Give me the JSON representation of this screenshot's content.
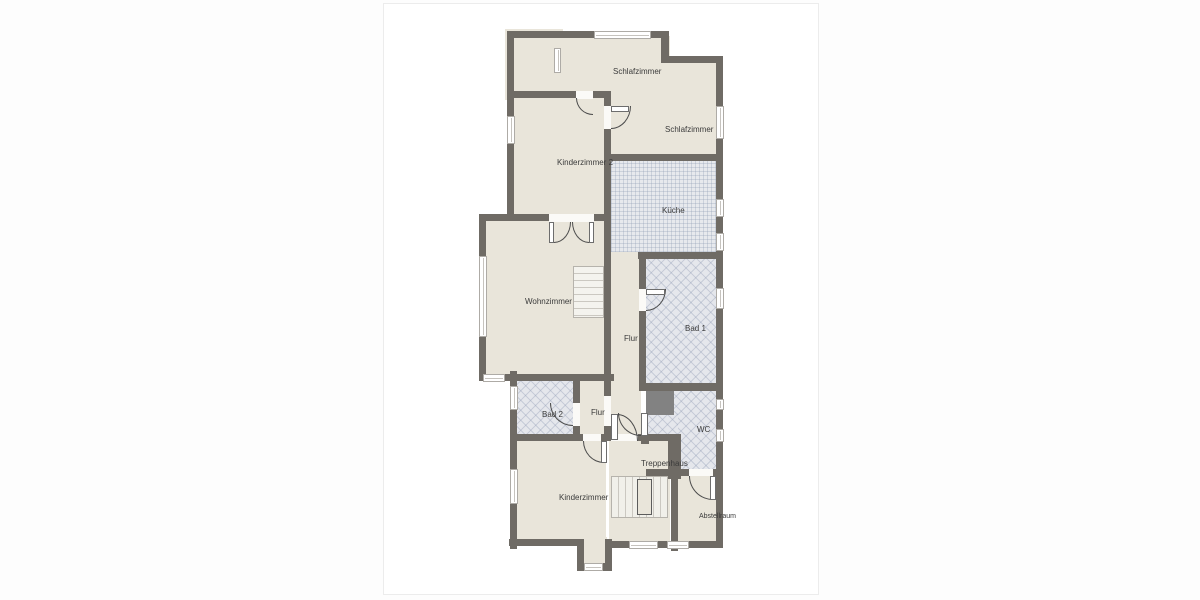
{
  "page": {
    "card": {
      "x": 383,
      "y": 3,
      "w": 434,
      "h": 590,
      "background": "#ffffff",
      "border_color": "#ececec"
    }
  },
  "colors": {
    "wall": "#6f6b65",
    "room_floor": "#e9e5da",
    "kitchen_tile": "#e7e9ed",
    "bath_tile": "#e5e7ec",
    "shaft": "#828282",
    "label_text": "#3b3b3b"
  },
  "floorplan": {
    "rooms": [
      {
        "id": "anteroom",
        "label": "",
        "lx": 0,
        "ly": 0,
        "floor": "room",
        "rects": [
          [
            123,
            27,
            54,
            67
          ]
        ]
      },
      {
        "id": "schlafzimmer-1",
        "label": "Schlafzimmer",
        "lx": 229,
        "ly": 63,
        "floor": "room",
        "rects": [
          [
            177,
            34,
            107,
            63
          ],
          [
            277,
            59,
            55,
            38
          ],
          [
            224,
            94,
            108,
            63
          ]
        ]
      },
      {
        "id": "schlafzimmer-2",
        "label": "Schlafzimmer",
        "lx": 281,
        "ly": 121,
        "floor": "room",
        "rects": []
      },
      {
        "id": "kinderzimmer-2",
        "label": "Kinderzimmer 2",
        "lx": 173,
        "ly": 154,
        "floor": "room",
        "rects": [
          [
            130,
            94,
            90,
            118
          ]
        ]
      },
      {
        "id": "kueche",
        "label": "Küche",
        "lx": 278,
        "ly": 202,
        "floor": "tile-grid",
        "rects": [
          [
            229,
            157,
            103,
            93
          ]
        ]
      },
      {
        "id": "wohnzimmer",
        "label": "Wohnzimmer",
        "lx": 141,
        "ly": 293,
        "floor": "room",
        "rects": [
          [
            102,
            214,
            118,
            156
          ]
        ]
      },
      {
        "id": "flur",
        "label": "Flur",
        "lx": 240,
        "ly": 330,
        "floor": "room",
        "rects": [
          [
            227,
            250,
            28,
            184
          ]
        ]
      },
      {
        "id": "bad-1",
        "label": "Bad 1",
        "lx": 301,
        "ly": 320,
        "floor": "tile-diag",
        "rects": [
          [
            262,
            255,
            70,
            124
          ]
        ]
      },
      {
        "id": "bad-2",
        "label": "Bad 2",
        "lx": 158,
        "ly": 406,
        "floor": "tile-diag",
        "rects": [
          [
            134,
            374,
            55,
            56
          ]
        ]
      },
      {
        "id": "flur-klein",
        "label": "Flur",
        "lx": 207,
        "ly": 404,
        "floor": "room",
        "rects": [
          [
            196,
            374,
            24,
            63
          ]
        ]
      },
      {
        "id": "wc",
        "label": "WC",
        "lx": 313,
        "ly": 421,
        "floor": "tile-diag",
        "rects": [
          [
            292,
            387,
            40,
            81
          ],
          [
            265,
            409,
            27,
            59
          ]
        ]
      },
      {
        "id": "treppenhaus",
        "label": "Treppenhaus",
        "lx": 257,
        "ly": 455,
        "floor": "room",
        "rects": [
          [
            227,
            437,
            57,
            100
          ]
        ]
      },
      {
        "id": "kinderzimmer",
        "label": "Kinderzimmer",
        "lx": 175,
        "ly": 489,
        "floor": "room",
        "rects": [
          [
            132,
            437,
            88,
            101
          ],
          [
            200,
            535,
            21,
            27
          ]
        ]
      },
      {
        "id": "abstellraum",
        "label": "Abstellraum",
        "lx": 315,
        "ly": 509,
        "floor": "room",
        "small": true,
        "rects": [
          [
            294,
            472,
            38,
            65
          ]
        ]
      }
    ],
    "walls": [
      [
        123,
        27,
        162,
        7
      ],
      [
        277,
        27,
        8,
        32
      ],
      [
        277,
        52,
        62,
        7
      ],
      [
        332,
        52,
        7,
        492
      ],
      [
        123,
        27,
        7,
        185
      ],
      [
        123,
        87,
        57,
        7
      ],
      [
        175,
        87,
        17,
        7
      ],
      [
        209,
        87,
        18,
        7
      ],
      [
        220,
        87,
        7,
        15
      ],
      [
        220,
        125,
        7,
        92
      ],
      [
        222,
        150,
        117,
        7
      ],
      [
        95,
        210,
        70,
        7
      ],
      [
        210,
        210,
        12,
        7
      ],
      [
        95,
        210,
        7,
        167
      ],
      [
        95,
        370,
        135,
        7
      ],
      [
        220,
        248,
        7,
        7
      ],
      [
        254,
        248,
        85,
        7
      ],
      [
        220,
        217,
        7,
        160
      ],
      [
        255,
        255,
        7,
        30
      ],
      [
        255,
        307,
        7,
        80
      ],
      [
        255,
        379,
        84,
        8
      ],
      [
        257,
        432,
        8,
        8
      ],
      [
        220,
        377,
        7,
        15
      ],
      [
        220,
        422,
        7,
        15
      ],
      [
        126,
        367,
        7,
        178
      ],
      [
        189,
        374,
        7,
        25
      ],
      [
        189,
        422,
        7,
        15
      ],
      [
        127,
        430,
        72,
        7
      ],
      [
        217,
        430,
        10,
        7
      ],
      [
        254,
        430,
        30,
        7
      ],
      [
        284,
        430,
        13,
        45
      ],
      [
        262,
        465,
        43,
        7
      ],
      [
        329,
        465,
        10,
        7
      ],
      [
        287,
        472,
        7,
        75
      ],
      [
        125,
        535,
        75,
        7
      ],
      [
        193,
        535,
        7,
        31
      ],
      [
        221,
        535,
        7,
        31
      ],
      [
        193,
        559,
        35,
        8
      ],
      [
        227,
        537,
        112,
        7
      ]
    ],
    "shafts": [
      [
        262,
        385,
        28,
        26
      ]
    ],
    "windows": [
      {
        "r": [
          210,
          27,
          57,
          8
        ],
        "o": "h"
      },
      {
        "r": [
          332,
          102,
          8,
          33
        ],
        "o": "v"
      },
      {
        "r": [
          332,
          195,
          8,
          18
        ],
        "o": "v"
      },
      {
        "r": [
          332,
          229,
          8,
          18
        ],
        "o": "v"
      },
      {
        "r": [
          332,
          284,
          8,
          21
        ],
        "o": "v"
      },
      {
        "r": [
          332,
          395,
          8,
          11
        ],
        "o": "v"
      },
      {
        "r": [
          332,
          425,
          8,
          13
        ],
        "o": "v"
      },
      {
        "r": [
          123,
          112,
          8,
          28
        ],
        "o": "v"
      },
      {
        "r": [
          95,
          252,
          8,
          81
        ],
        "o": "v"
      },
      {
        "r": [
          99,
          370,
          22,
          8
        ],
        "o": "h"
      },
      {
        "r": [
          126,
          382,
          8,
          24
        ],
        "o": "v"
      },
      {
        "r": [
          126,
          465,
          8,
          35
        ],
        "o": "v"
      },
      {
        "r": [
          200,
          559,
          19,
          8
        ],
        "o": "h"
      },
      {
        "r": [
          245,
          537,
          29,
          8
        ],
        "o": "h"
      },
      {
        "r": [
          283,
          537,
          22,
          8
        ],
        "o": "h"
      },
      {
        "r": [
          170,
          44,
          7,
          25
        ],
        "o": "v"
      }
    ],
    "door_gaps": [
      [
        192,
        87,
        17,
        8
      ],
      [
        220,
        102,
        7,
        23
      ],
      [
        165,
        210,
        45,
        8
      ],
      [
        255,
        285,
        7,
        22
      ],
      [
        189,
        399,
        7,
        23
      ],
      [
        199,
        430,
        18,
        7
      ],
      [
        227,
        430,
        27,
        7
      ],
      [
        305,
        465,
        24,
        7
      ],
      [
        220,
        392,
        7,
        30
      ]
    ],
    "door_leaves": [
      [
        227,
        102,
        18,
        6
      ],
      [
        165,
        218,
        5,
        21
      ],
      [
        205,
        218,
        5,
        21
      ],
      [
        262,
        285,
        19,
        6
      ],
      [
        257,
        409,
        7,
        23
      ],
      [
        217,
        437,
        6,
        22
      ],
      [
        227,
        410,
        7,
        26
      ],
      [
        326,
        472,
        6,
        24
      ]
    ],
    "door_arcs": [
      {
        "r": [
          192,
          94,
          17,
          17
        ],
        "c": "bl"
      },
      {
        "r": [
          227,
          102,
          20,
          23
        ],
        "c": "br"
      },
      {
        "r": [
          170,
          218,
          17,
          21
        ],
        "c": "br"
      },
      {
        "r": [
          188,
          218,
          17,
          21
        ],
        "c": "bl"
      },
      {
        "r": [
          262,
          285,
          20,
          22
        ],
        "c": "br"
      },
      {
        "r": [
          234,
          409,
          23,
          23
        ],
        "c": "bl"
      },
      {
        "r": [
          166,
          399,
          23,
          23
        ],
        "c": "bl"
      },
      {
        "r": [
          199,
          437,
          21,
          22
        ],
        "c": "bl"
      },
      {
        "r": [
          233,
          410,
          21,
          27
        ],
        "c": "tr"
      },
      {
        "r": [
          305,
          472,
          24,
          24
        ],
        "c": "bl"
      }
    ],
    "stairs": [
      {
        "r": [
          189,
          262,
          31,
          52
        ],
        "o": "h"
      },
      {
        "r": [
          227,
          472,
          57,
          42
        ],
        "o": "v",
        "core": [
          253,
          475,
          15,
          36
        ]
      }
    ]
  }
}
